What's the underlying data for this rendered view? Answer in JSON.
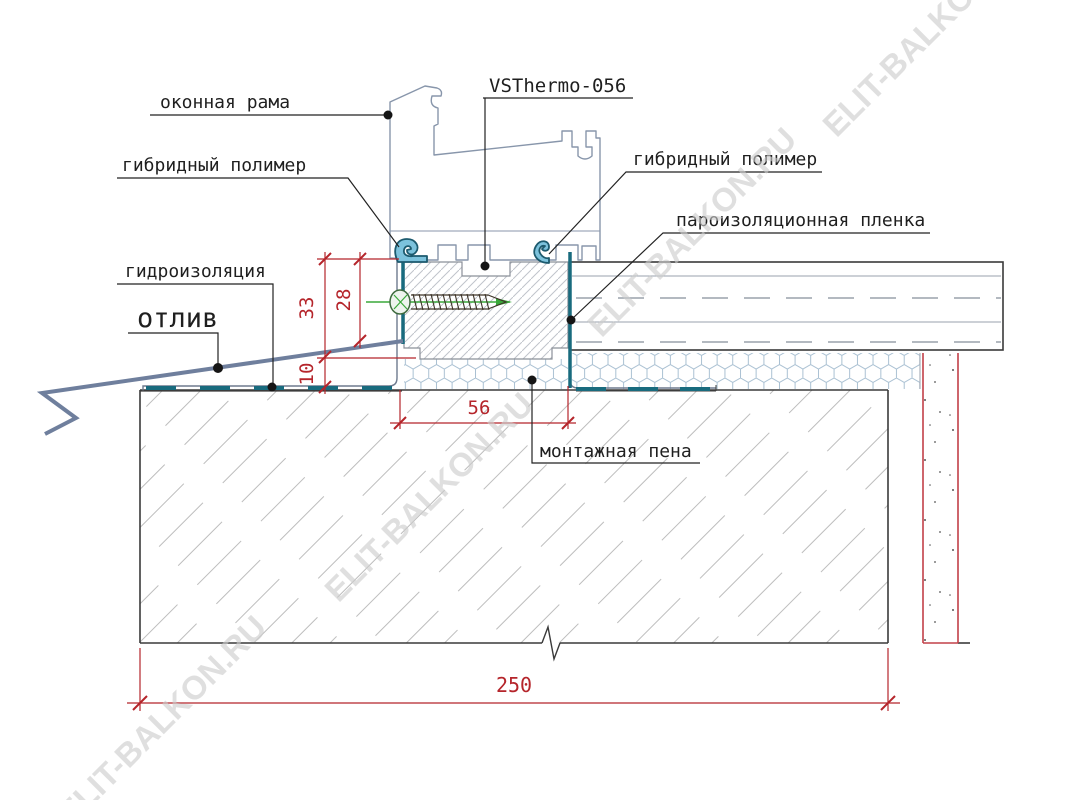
{
  "drawing": {
    "product_label": "VSThermo-056",
    "callouts": {
      "window_frame": "оконная рама",
      "hybrid_polymer_left": "гибридный полимер",
      "hybrid_polymer_right": "гибридный полимер",
      "vapor_barrier_film": "пароизоляционная пленка",
      "waterproofing": "гидроизоляция",
      "drip_flashing": "отлив",
      "mounting_foam": "монтажная пена"
    },
    "dimensions_mm": {
      "d33": "33",
      "d28": "28",
      "d10": "10",
      "d56": "56",
      "d250": "250"
    },
    "watermark_text": "ELIT-BALKON.RU",
    "colors": {
      "dimension_red": "#b5252b",
      "membrane_teal": "#196b7e",
      "gasket_blue": "#7cc2dc",
      "profile_grey": "#8896ab",
      "screw_green": "#3aa83a",
      "drip_slate": "#6f7f9d",
      "watermark_grey": "#cdcdcd"
    }
  }
}
